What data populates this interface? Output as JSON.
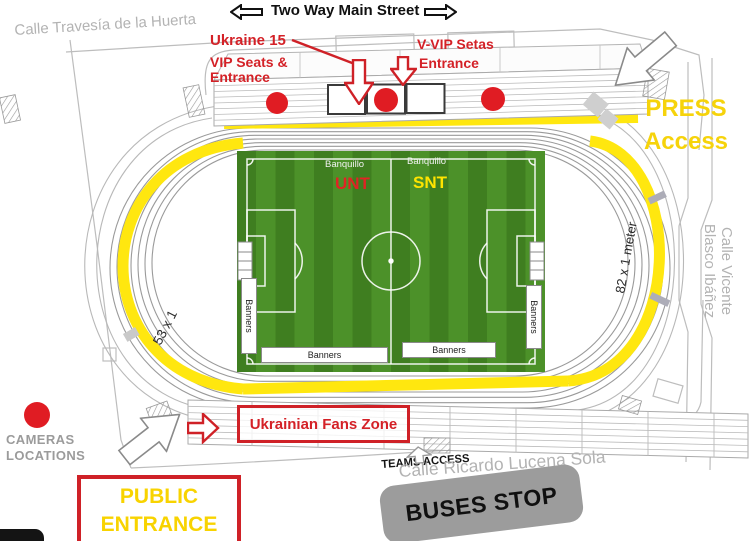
{
  "title_street": "Two Way Main Street",
  "streets": {
    "travesia": "Calle Travesía de la Huerta",
    "vicente_line1": "Calle Vicente",
    "vicente_line2": "Blasco Ibáñez",
    "ricardo": "Calle Ricardo Lucena Sola"
  },
  "entrances": {
    "ukraine15": "Ukraine 15",
    "vip_line1": "VIP Seats &",
    "vip_line2": "Entrance",
    "vvip_line1": "V-VIP Setas",
    "vvip_line2": "Entrance",
    "press_line1": "PRESS",
    "press_line2": "Access",
    "public_line1": "PUBLIC",
    "public_line2": "ENTRANCE",
    "fans_zone": "Ukrainian Fans Zone",
    "teams_access": "TEAMS ACCESS",
    "buses_stop": "BUSES STOP"
  },
  "legend": {
    "cameras_line1": "CAMERAS",
    "cameras_line2": "LOCATIONS"
  },
  "track": {
    "left_dim": "53 x 1",
    "right_dim": "82 x 1 meter"
  },
  "pitch": {
    "banquillo": "Banquillo",
    "team_left": "UNT",
    "team_right": "SNT",
    "banners": "Banners"
  },
  "colors": {
    "red": "#d42127",
    "path_yellow": "#ffe70f",
    "text_yellow": "#f6d30b",
    "pitch_light": "#4c9129",
    "pitch_dark": "#3f7e20",
    "gray_text": "#b3b3b3",
    "bus_gray": "#9c9c9c"
  }
}
